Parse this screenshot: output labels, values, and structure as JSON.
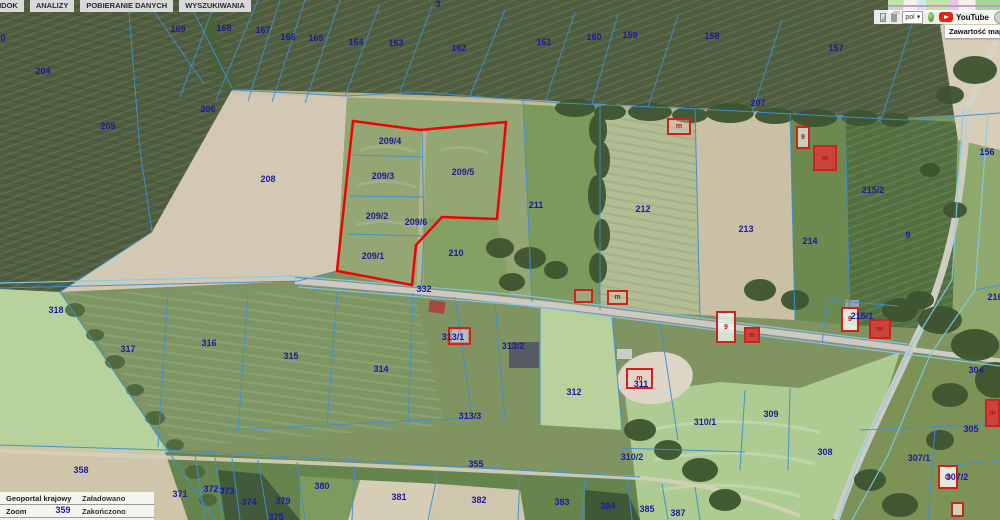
{
  "menu": {
    "items": [
      {
        "label": "WIDOK"
      },
      {
        "label": "ANALIZY"
      },
      {
        "label": "POBIERANIE DANYCH"
      },
      {
        "label": "WYSZUKIWANIA"
      }
    ]
  },
  "toolbar": {
    "language_value": "pol",
    "youtube_label": "YouTube",
    "map_contents_tooltip": "Zawartość map"
  },
  "status_panel": {
    "rows": [
      {
        "source": "Geoportal krajowy",
        "status": "Załadowano"
      },
      {
        "source": "Zoom",
        "status": "Zakończono"
      },
      {
        "source": "Geoportal krajowy",
        "status": "Załadowano"
      }
    ]
  },
  "map": {
    "colors": {
      "selection_red": "#f40000",
      "cadastral_blue": "#3f8fd4",
      "road_edge_cyan": "#7ecdee",
      "label_navy": "#1b1b9e",
      "building_red": "#cf221d"
    },
    "selection": {
      "points": "353,121 420,130 506,122 497,219 442,217 416,245 412,285 337,271",
      "parcels_inside": [
        "209/1",
        "209/2",
        "209/3",
        "209/4",
        "209/5",
        "209/6"
      ]
    },
    "parcel_labels": [
      {
        "text": "169",
        "x": 178,
        "y": 29
      },
      {
        "text": "168",
        "x": 224,
        "y": 28
      },
      {
        "text": "167",
        "x": 263,
        "y": 30
      },
      {
        "text": "166",
        "x": 288,
        "y": 37
      },
      {
        "text": "165",
        "x": 316,
        "y": 38
      },
      {
        "text": "164",
        "x": 356,
        "y": 42
      },
      {
        "text": "163",
        "x": 396,
        "y": 43
      },
      {
        "text": "162",
        "x": 459,
        "y": 48
      },
      {
        "text": "161",
        "x": 544,
        "y": 42
      },
      {
        "text": "160",
        "x": 594,
        "y": 37
      },
      {
        "text": "159",
        "x": 630,
        "y": 35
      },
      {
        "text": "158",
        "x": 712,
        "y": 36
      },
      {
        "text": "157",
        "x": 836,
        "y": 48
      },
      {
        "text": "156",
        "x": 987,
        "y": 152
      },
      {
        "text": "204",
        "x": 43,
        "y": 71
      },
      {
        "text": "205",
        "x": 108,
        "y": 126
      },
      {
        "text": "206",
        "x": 208,
        "y": 109
      },
      {
        "text": "207",
        "x": 758,
        "y": 103
      },
      {
        "text": "208",
        "x": 268,
        "y": 179
      },
      {
        "text": "209/4",
        "x": 390,
        "y": 141
      },
      {
        "text": "209/3",
        "x": 383,
        "y": 176
      },
      {
        "text": "209/5",
        "x": 463,
        "y": 172
      },
      {
        "text": "209/2",
        "x": 377,
        "y": 216
      },
      {
        "text": "209/6",
        "x": 416,
        "y": 222
      },
      {
        "text": "209/1",
        "x": 373,
        "y": 256
      },
      {
        "text": "210",
        "x": 456,
        "y": 253
      },
      {
        "text": "211",
        "x": 536,
        "y": 205
      },
      {
        "text": "212",
        "x": 643,
        "y": 209
      },
      {
        "text": "213",
        "x": 746,
        "y": 229
      },
      {
        "text": "214",
        "x": 810,
        "y": 241
      },
      {
        "text": "215/2",
        "x": 873,
        "y": 190
      },
      {
        "text": "215/1",
        "x": 862,
        "y": 316
      },
      {
        "text": "216",
        "x": 995,
        "y": 297
      },
      {
        "text": "9",
        "x": 908,
        "y": 235
      },
      {
        "text": "332",
        "x": 424,
        "y": 289
      },
      {
        "text": "304",
        "x": 976,
        "y": 370
      },
      {
        "text": "318",
        "x": 56,
        "y": 310
      },
      {
        "text": "317",
        "x": 128,
        "y": 349
      },
      {
        "text": "316",
        "x": 209,
        "y": 343
      },
      {
        "text": "315",
        "x": 291,
        "y": 356
      },
      {
        "text": "314",
        "x": 381,
        "y": 369
      },
      {
        "text": "313/1",
        "x": 453,
        "y": 337
      },
      {
        "text": "313/2",
        "x": 513,
        "y": 346
      },
      {
        "text": "313/3",
        "x": 470,
        "y": 416
      },
      {
        "text": "312",
        "x": 574,
        "y": 392
      },
      {
        "text": "311",
        "x": 641,
        "y": 384
      },
      {
        "text": "310/1",
        "x": 705,
        "y": 422
      },
      {
        "text": "309",
        "x": 771,
        "y": 414
      },
      {
        "text": "310/2",
        "x": 632,
        "y": 457
      },
      {
        "text": "308",
        "x": 825,
        "y": 452
      },
      {
        "text": "305",
        "x": 971,
        "y": 429
      },
      {
        "text": "307/1",
        "x": 919,
        "y": 458
      },
      {
        "text": "307/2",
        "x": 957,
        "y": 477
      },
      {
        "text": "355",
        "x": 476,
        "y": 464
      },
      {
        "text": "358",
        "x": 81,
        "y": 470
      },
      {
        "text": "359",
        "x": 63,
        "y": 510
      },
      {
        "text": "371",
        "x": 180,
        "y": 494
      },
      {
        "text": "372",
        "x": 211,
        "y": 489
      },
      {
        "text": "373",
        "x": 227,
        "y": 491
      },
      {
        "text": "374",
        "x": 249,
        "y": 502
      },
      {
        "text": "375",
        "x": 276,
        "y": 517
      },
      {
        "text": "379",
        "x": 283,
        "y": 501
      },
      {
        "text": "380",
        "x": 322,
        "y": 486
      },
      {
        "text": "381",
        "x": 399,
        "y": 497
      },
      {
        "text": "382",
        "x": 479,
        "y": 500
      },
      {
        "text": "383",
        "x": 562,
        "y": 502
      },
      {
        "text": "384",
        "x": 608,
        "y": 506
      },
      {
        "text": "385",
        "x": 647,
        "y": 509
      },
      {
        "text": "387",
        "x": 678,
        "y": 513
      },
      {
        "text": "0",
        "x": 3,
        "y": 38
      },
      {
        "text": "3",
        "x": 438,
        "y": 4
      }
    ],
    "buildings": [
      {
        "x": 667,
        "y": 118,
        "w": 24,
        "h": 17,
        "fill": "rgba(240,200,200,0.35)",
        "label": "m"
      },
      {
        "x": 796,
        "y": 126,
        "w": 14,
        "h": 23,
        "fill": "rgba(255,255,255,0.6)",
        "label": "9"
      },
      {
        "x": 813,
        "y": 145,
        "w": 24,
        "h": 26,
        "fill": "#c8443c",
        "label": "m"
      },
      {
        "x": 574,
        "y": 289,
        "w": 19,
        "h": 14,
        "fill": "rgba(240,200,200,0.3)",
        "label": ""
      },
      {
        "x": 607,
        "y": 290,
        "w": 21,
        "h": 15,
        "fill": "rgba(240,200,200,0.3)",
        "label": "m"
      },
      {
        "x": 448,
        "y": 327,
        "w": 23,
        "h": 18,
        "fill": "rgba(240,200,200,0.25)",
        "label": ""
      },
      {
        "x": 626,
        "y": 368,
        "w": 27,
        "h": 21,
        "fill": "rgba(240,200,200,0.35)",
        "label": "m"
      },
      {
        "x": 716,
        "y": 311,
        "w": 20,
        "h": 32,
        "fill": "rgba(255,255,255,0.7)",
        "label": "9"
      },
      {
        "x": 744,
        "y": 327,
        "w": 16,
        "h": 16,
        "fill": "#c8443c",
        "label": "m"
      },
      {
        "x": 841,
        "y": 307,
        "w": 18,
        "h": 25,
        "fill": "rgba(255,255,255,0.8)",
        "label": "9"
      },
      {
        "x": 869,
        "y": 319,
        "w": 22,
        "h": 20,
        "fill": "#c8443c",
        "label": "m"
      },
      {
        "x": 938,
        "y": 465,
        "w": 20,
        "h": 24,
        "fill": "rgba(255,255,255,0.8)",
        "label": "m"
      },
      {
        "x": 951,
        "y": 502,
        "w": 13,
        "h": 15,
        "fill": "rgba(255,255,255,0.6)",
        "label": ""
      },
      {
        "x": 985,
        "y": 399,
        "w": 15,
        "h": 28,
        "fill": "#c8443c",
        "label": "m"
      }
    ]
  }
}
